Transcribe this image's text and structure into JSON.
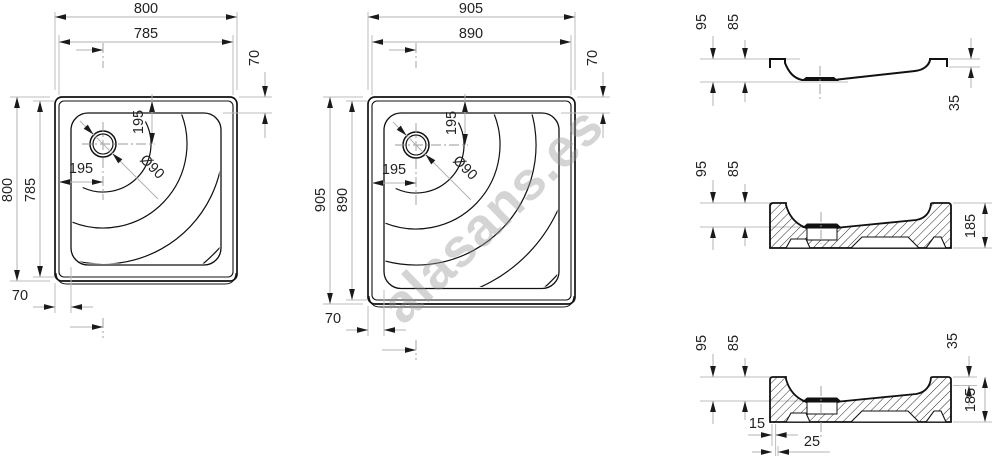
{
  "watermark": "alasans.es",
  "plan_small": {
    "width_outer": "800",
    "width_inner": "785",
    "offset_right": "70",
    "height_outer": "800",
    "height_inner": "785",
    "drain_from_top": "195",
    "drain_from_left": "195",
    "drain_diameter": "Ø90",
    "offset_bottom": "70"
  },
  "plan_large": {
    "width_outer": "905",
    "width_inner": "890",
    "offset_right": "70",
    "height_outer": "905",
    "height_inner": "890",
    "drain_from_top": "195",
    "drain_from_left": "195",
    "drain_diameter": "Ø90",
    "offset_bottom": "70"
  },
  "section_shell": {
    "h_outer": "95",
    "h_inner": "85",
    "lip": "35"
  },
  "section_base": {
    "h_outer": "95",
    "h_inner": "85",
    "total": "185"
  },
  "section_full": {
    "h_outer": "95",
    "h_inner": "85",
    "lip": "35",
    "total": "185",
    "off_a": "15",
    "off_b": "25"
  }
}
